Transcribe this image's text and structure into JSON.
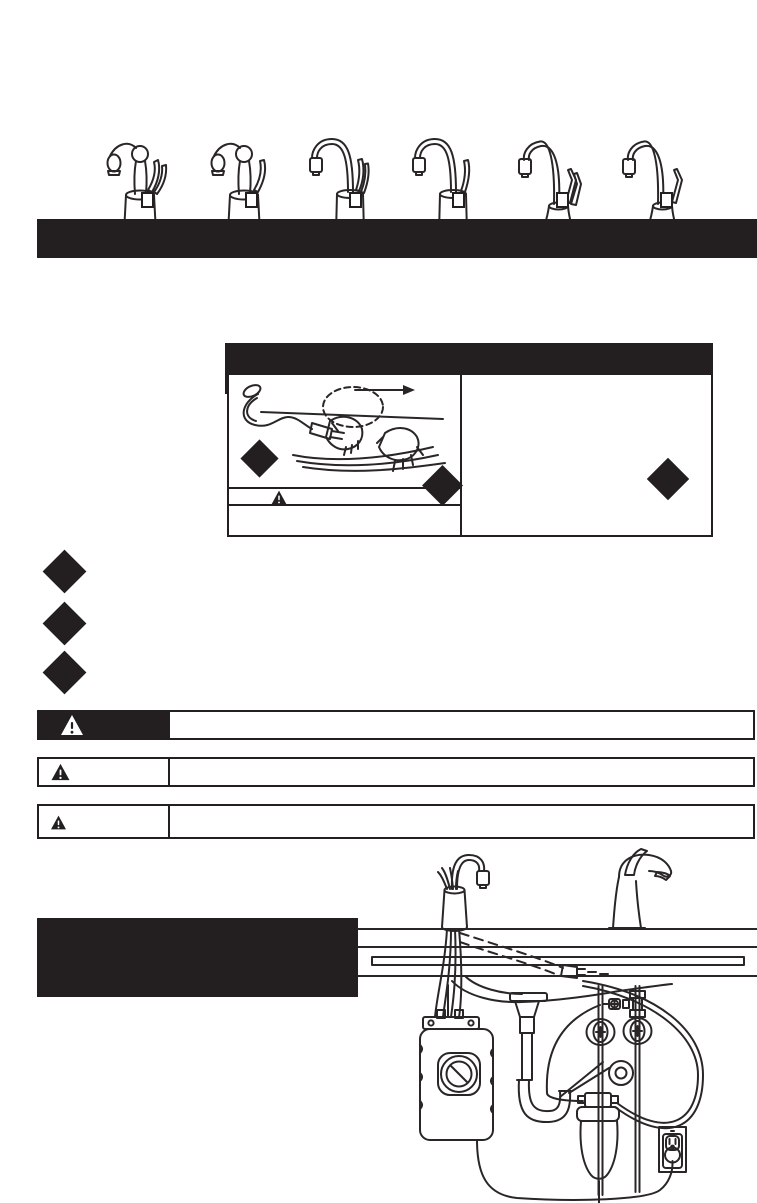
{
  "colors": {
    "ink": "#231f20",
    "paper": "#ffffff",
    "counter_gray": "#c4c5c7",
    "cord_gray": "#b3b4b6"
  },
  "model_selector": {
    "checkbox_count": 6,
    "items": [
      {
        "id": "model-option-1",
        "style": "classic-two-handle",
        "checked": false
      },
      {
        "id": "model-option-2",
        "style": "classic-single-handle",
        "checked": false
      },
      {
        "id": "model-option-3",
        "style": "gooseneck-two-handle",
        "checked": false
      },
      {
        "id": "model-option-4",
        "style": "gooseneck-single-handle",
        "checked": false
      },
      {
        "id": "model-option-5",
        "style": "contemporary-two-lever",
        "checked": false
      },
      {
        "id": "model-option-6",
        "style": "contemporary-single-lever",
        "checked": false
      }
    ]
  },
  "title_banner": {
    "id": "title-banner"
  },
  "warning_panel": {
    "id": "warning-panel",
    "diamond_count": 3,
    "icons": [
      "warning-triangle-icon"
    ],
    "illustration": "hands-plugging-power-cord-with-arrow"
  },
  "bullet_diamonds": {
    "count": 3
  },
  "safety_bars": [
    {
      "kind": "warning-bar",
      "icon": "warning-triangle-icon",
      "label_style": "black-cell"
    },
    {
      "kind": "caution-bar",
      "icon": "warning-triangle-icon",
      "label_style": "outlined-cell"
    },
    {
      "kind": "notice-bar",
      "icon": "warning-triangle-icon",
      "label_style": "outlined-cell"
    }
  ],
  "subtitle_block": {
    "id": "section-title-block"
  },
  "installation_diagram": {
    "components": [
      "hot-water-dispenser-faucet",
      "kitchen-faucet",
      "countertop",
      "sink-basin",
      "dispenser-tank",
      "water-filter",
      "p-trap-drain",
      "shutoff-valves",
      "tee-fitting",
      "power-cord-connector",
      "wall-outlet-with-plug"
    ]
  }
}
